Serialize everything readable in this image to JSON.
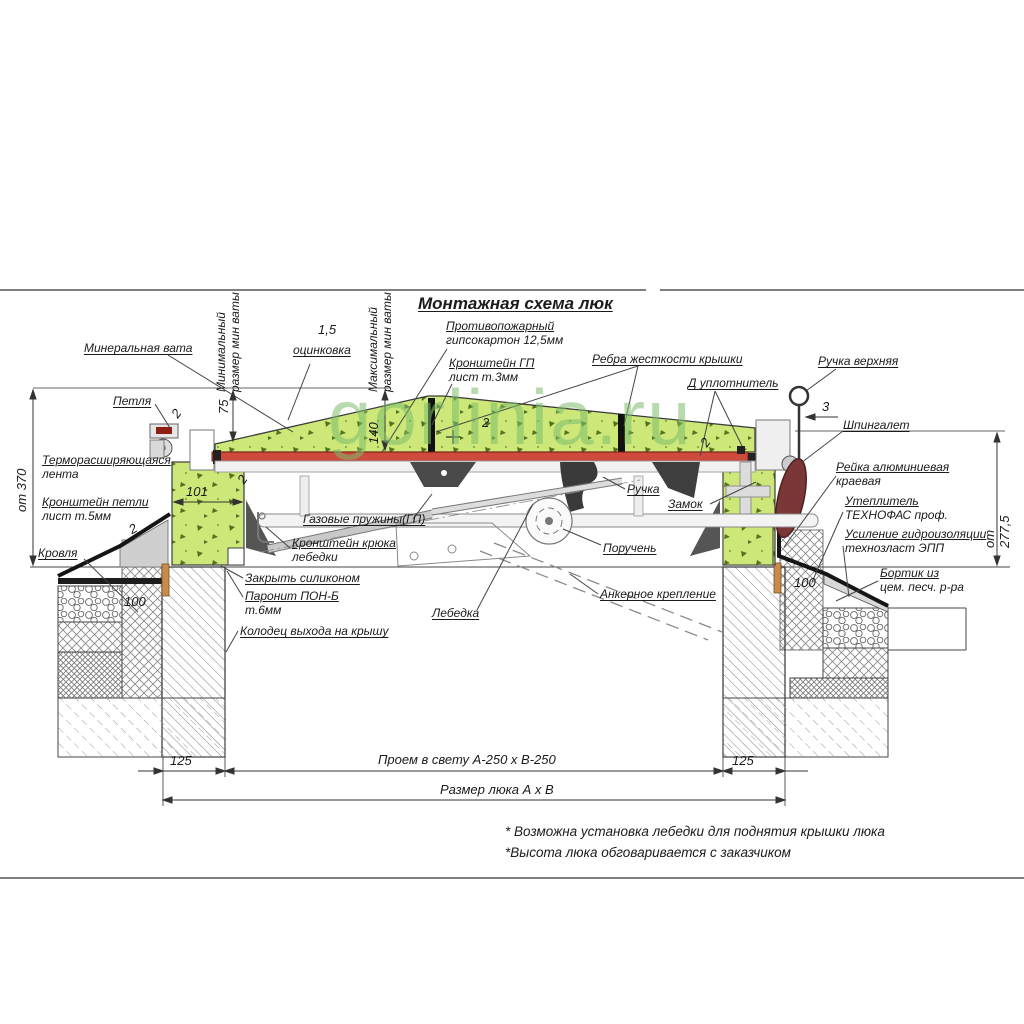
{
  "title": "Монтажная схема люк",
  "watermark": "gorlinia.ru",
  "callouts": {
    "mineral_wool": "Минеральная вата",
    "min_wool": "Минимальный\nразмер мин ваты",
    "zinc_value": "1,5",
    "zinc": "оцинковка",
    "max_wool": "Максимальный\nразмер мин ваты",
    "fireproof": "Противопожарный\nгипсокартон 12,5мм",
    "gp_bracket": "Кронштейн ГП\nлист т.3мм",
    "ribs": "Ребра жесткости крышки",
    "seal": "Д уплотнитель",
    "handle_top": "Ручка верхняя",
    "latch": "Шпингалет",
    "hinge": "Петля",
    "thermo": "Терморасширяющаяся\nлента",
    "hinge_bracket": "Кронштейн петли\nлист т.5мм",
    "roof": "Кровля",
    "silicone": "Закрыть силиконом",
    "paronite": "Паронит ПОН-Б\nт.6мм",
    "well": "Колодец выхода на крышу",
    "gas_springs": "Газовые пружины(ГП)",
    "winch_hook": "Кронштейн крюка\nлебедки",
    "handle": "Ручка",
    "lock": "Замок",
    "handrail": "Поручень",
    "winch": "Лебедка",
    "anchor": "Анкерное крепление",
    "alu_rail": "Рейка алюминиевая\nкраевая",
    "insulation": "Утеплитель\nТЕХНОФАС проф.",
    "waterproof": "Усиление гидроизоляции\nтехнозласт ЭПП",
    "curb": "Бортик из\nцем. песч. р-ра"
  },
  "dims": {
    "left_height": "от 370",
    "right_height": "от 277,5",
    "d75": "75",
    "d140": "140",
    "d101": "101",
    "d100": "100",
    "d125": "125",
    "d2": "2",
    "d3": "3",
    "opening": "Проем в свету А-250 х В-250",
    "hatch_size": "Размер люка А х В"
  },
  "notes": {
    "note1": "* Возможна установка лебедки для поднятия крышки люка",
    "note2": "*Высота люка обговаривается с заказчиком"
  },
  "colors": {
    "wool_green": "#cde878",
    "seal_red": "#cd4a3c",
    "latch_burgundy": "#7b3737",
    "watermark_green": "#7bbc6e",
    "dowel_orange": "#c98b4b",
    "line_dark": "#333333"
  }
}
